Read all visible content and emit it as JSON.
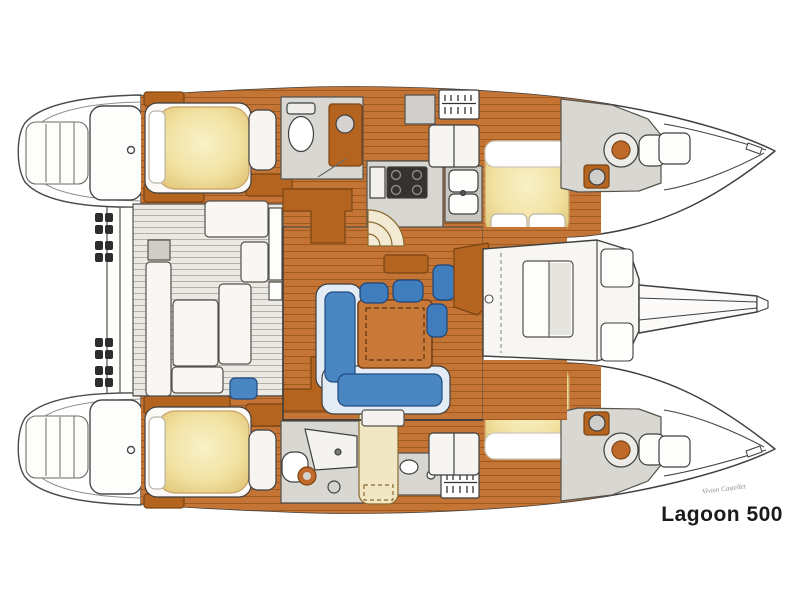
{
  "title": {
    "label": "Lagoon 500"
  },
  "signature": {
    "label": "Vivien Castellet"
  },
  "diagram": {
    "kind": "catamaran interior floor plan, top view, bows pointing right",
    "hulls": 2,
    "features": [
      "stepped swim transoms on both sterns",
      "four double cabins with yellow mattresses",
      "two mid-hull bathrooms and two forward bow heads with round toilets",
      "central saloon with L-shaped blue sofa, square wood table and four blue stools",
      "galley with stove and twin sinks",
      "aft cockpit with slatted floor and white bench seating",
      "forward cockpit lounge between the hulls",
      "bowsprit beam extending forward on the centerline"
    ]
  },
  "palette": {
    "background": "#ffffff",
    "outline": "#3f3f3f",
    "wood": "#c47536",
    "wood_dark": "#b4641f",
    "plank_line": "#9e5a1f",
    "mattress_yellow": "#f2e3a4",
    "sofa_blue": "#4a86c2",
    "sofa_blue_dark": "#214b80",
    "counter_gray": "#d7d6d1",
    "deck_white": "#f7f6f2",
    "title_text": "#1b1b1b"
  }
}
